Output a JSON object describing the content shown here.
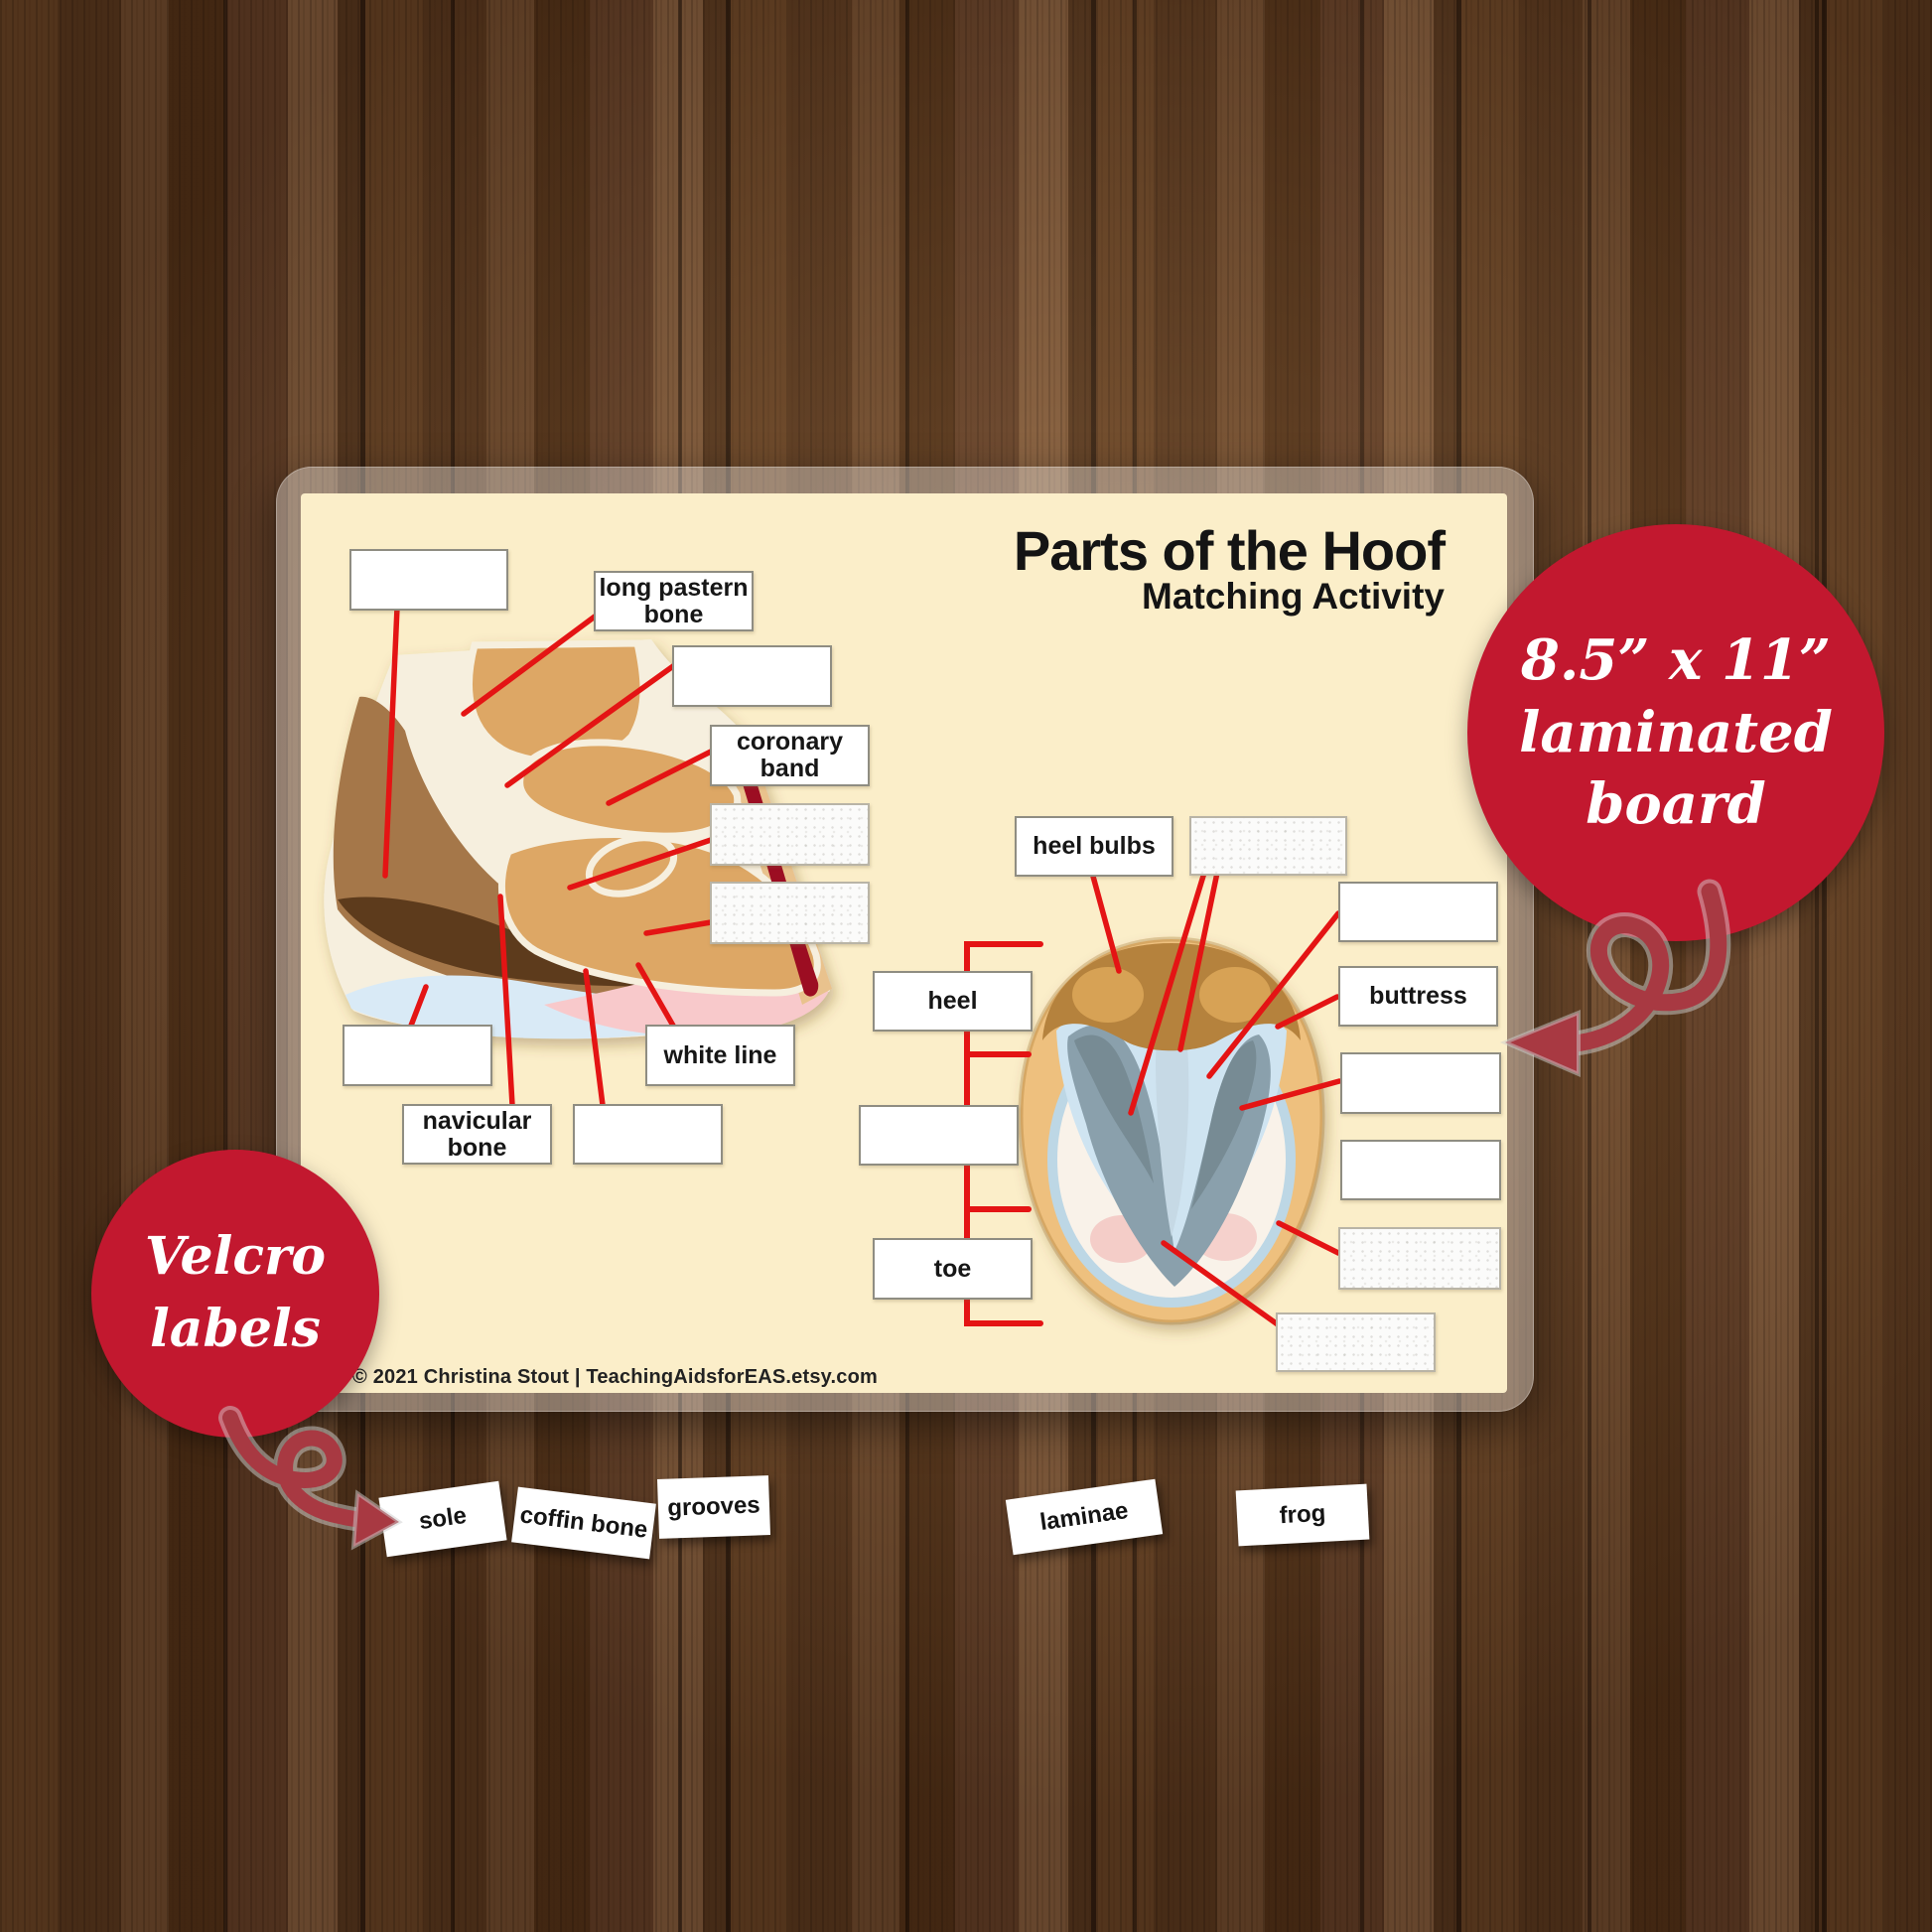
{
  "board": {
    "title": "Parts of the Hoof",
    "subtitle": "Matching Activity",
    "copyright": "© 2021 Christina Stout   |   TeachingAidsforEAS.etsy.com",
    "left_diagram": {
      "description": "hoof lateral cross-section",
      "long_pastern": "long pastern bone",
      "coronary_band": "coronary band",
      "white_line": "white line",
      "navicular": "navicular bone"
    },
    "right_diagram": {
      "description": "hoof bottom view",
      "heel_bulbs": "heel bulbs",
      "buttress": "buttress",
      "heel": "heel",
      "toe": "toe"
    }
  },
  "badges": {
    "size_badge": {
      "lines": [
        "8.5” x 11”",
        "laminated",
        "board"
      ]
    },
    "velcro_badge": {
      "lines": [
        "Velcro",
        "labels"
      ]
    }
  },
  "velcro_tiles": [
    "sole",
    "coffin bone",
    "grooves",
    "laminae",
    "frog"
  ],
  "colors": {
    "accent_red": "#c2182f",
    "arrow_maroon": "#a83942",
    "leader_line_red": "#e41414",
    "board_cream": "#fbeec9"
  }
}
